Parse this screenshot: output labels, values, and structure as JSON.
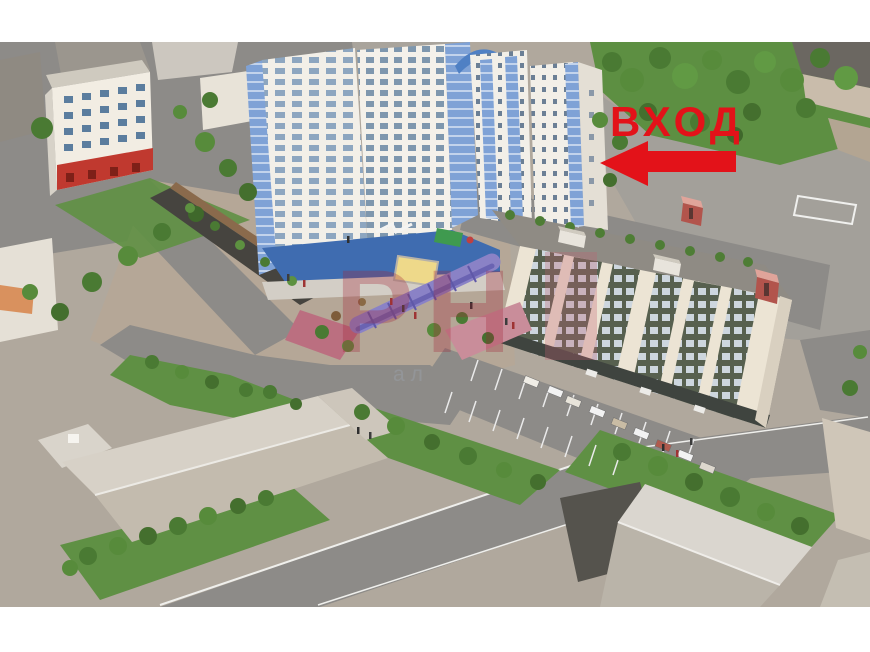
{
  "meta": {
    "description": "3D aerial architectural rendering of a residential complex; red arrow marks the building entrance",
    "canvas_width": 870,
    "canvas_height": 652
  },
  "annotation": {
    "entrance_label": "ВХОД",
    "entrance_color": "#e31219",
    "arrow_color": "#e31219",
    "arrow_direction": "left"
  },
  "watermark": {
    "letters": "РН",
    "subtext": "ал",
    "color": "#a32638",
    "subtext_color": "#9aa0a8"
  },
  "palette": {
    "letterbox_white": "#ffffff",
    "ground": "#b0a89d",
    "road_gray": "#8d8b88",
    "sidewalk": "#d3cec6",
    "lawn_green": "#5f9044",
    "tree_dark": "#446f2e",
    "tree_mid": "#4a7a33",
    "tree_light": "#619a44",
    "tower_white": "#f2efe8",
    "glass_blue": "#7fa2d6",
    "podium_blue": "#3f6cb0",
    "facade_cream": "#ece4d4",
    "window_band_green": "#57604f",
    "roof_gray": "#8f8b84",
    "kiosk_red": "#b2544c",
    "ground_floor_red": "#c0392f",
    "arcade_purple": "#8a82c6",
    "sandbox_yellow": "#eed98a",
    "dark_building": "#55534d"
  }
}
